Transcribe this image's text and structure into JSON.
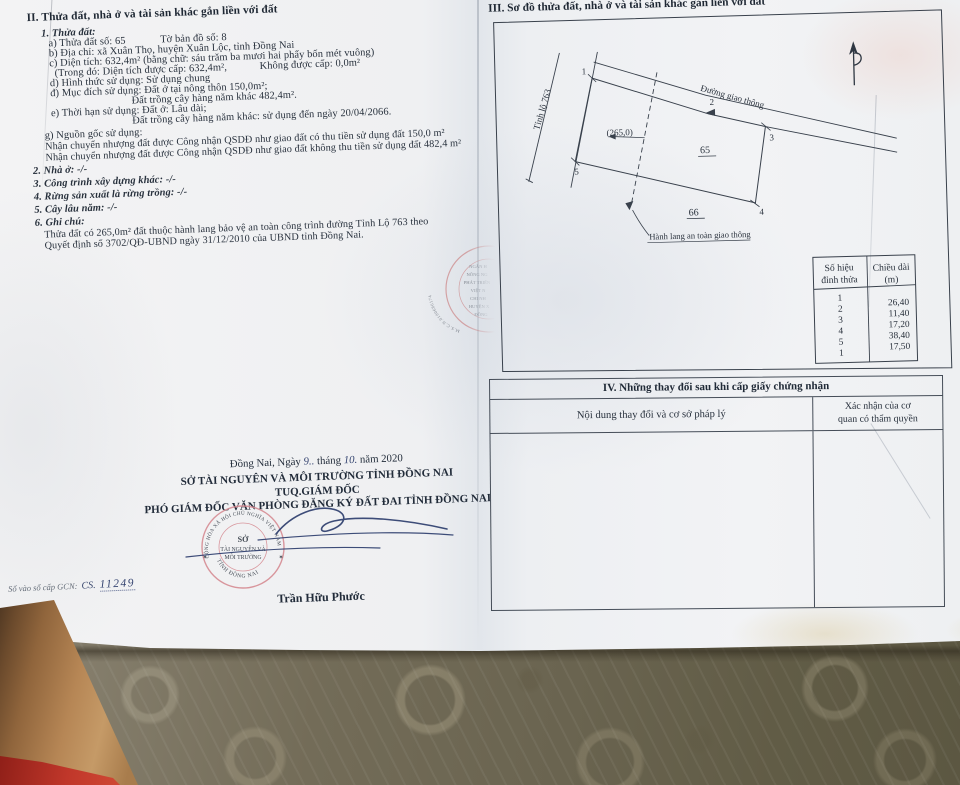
{
  "left": {
    "section2_title": "II. Thửa đất, nhà ở và tài sản khác gắn liền với đất",
    "item1_title": "1. Thửa đất:",
    "a_parcel": "a) Thửa đất số:  65",
    "a_map": "Tờ bản đồ số:   8",
    "b_address": "b) Địa chỉ: xã Xuân Thọ, huyện Xuân Lộc, tỉnh Đồng Nai",
    "c_area": "c) Diện tích: 632,4m² (bằng chữ: sáu trăm ba mươi hai phẩy bốn mét vuông)",
    "c2_in": "(Trong đó: Diện tích được cấp: 632,4m²,",
    "c2_not": "Không được cấp: 0,0m²",
    "d_form": "d) Hình thức sử dụng: Sử dụng chung",
    "dd_purpose": "đ) Mục đích sử dụng: Đất ở tại nông thôn 150,0m²;",
    "dd_purpose2": "Đất trồng cây hàng năm khác 482,4m².",
    "e_term": "e) Thời hạn sử dụng: Đất ở: Lâu dài;",
    "e_term2": "Đất trồng cây hàng năm khác: sử dụng đến ngày 20/04/2066.",
    "g_origin": "g) Nguồn gốc sử dụng:",
    "g_origin2": "Nhận chuyển nhượng đất được Công nhận QSDĐ như giao đất có thu tiền sử dụng đất 150,0 m²",
    "g_origin3": "Nhận chuyển nhượng đất được Công nhận QSDĐ như giao đất không thu tiền sử dụng đất 482,4 m²",
    "item2": "2. Nhà ở: -/-",
    "item3": "3. Công trình xây dựng khác:  -/-",
    "item4": "4. Rừng sản xuất là rừng trồng: -/-",
    "item5": "5. Cây lâu năm: -/-",
    "item6": "6. Ghi chú:",
    "note1": "Thửa đất có 265,0m² đất thuộc hành lang bảo vệ an toàn công trình đường Tỉnh Lộ 763 theo",
    "note2": "Quyết định số 3702/QĐ-UBND ngày 31/12/2010 của UBND tỉnh Đồng Nai.",
    "date_pre": "Đồng Nai, Ngày",
    "date_day": "9..",
    "date_mid": "tháng",
    "date_month": "10.",
    "date_post": "năm 2020",
    "org1": "SỞ TÀI NGUYÊN VÀ MÔI TRƯỜNG TỈNH ĐỒNG NAI",
    "org2": "TUQ.GIÁM ĐỐC",
    "org3": "PHÓ GIÁM ĐỐC VĂN PHÒNG ĐĂNG KÝ ĐẤT ĐAI TỈNH ĐỒNG NAI",
    "signer_name": "Trần Hữu Phước",
    "gcn_label": "Số vào sổ cấp GCN:",
    "gcn_code": "CS.",
    "gcn_number": "11249",
    "seal": {
      "ring_top": "CỘNG HÒA XÃ HỘI CHỦ NGHĨA VIỆT NAM",
      "center1": "SỞ",
      "center2": "TÀI NGUYÊN VÀ",
      "center3": "MÔI TRƯỜNG",
      "ring_bottom": "TỈNH ĐỒNG NAI",
      "star_left": "✶",
      "star_right": "✶"
    },
    "bank_stamp": {
      "arc": "M.S.C.N.0100686174",
      "l0": "NGÂN H",
      "l1": "NÔNG NG",
      "l2": "PHÁT TRIỂN",
      "l3": "VIỆT N",
      "l4": "CHI NH",
      "l5": "HUYỆN X",
      "l6": "ĐỒNG"
    }
  },
  "right": {
    "section3_title": "III. Sơ đồ thửa đất, nhà ở và tài sản khác gắn liền với đất",
    "diagram": {
      "road_left": "Tỉnh lộ 763",
      "road_top": "Đường giao thông",
      "area_note": "(265,0)",
      "parcel_no": "65",
      "parcel_below": "66",
      "corridor": "Hành lang an toàn giao thông",
      "v1": "1",
      "v2": "2",
      "v3": "3",
      "v4": "4",
      "v5": "5"
    },
    "vertex_table": {
      "h1a": "Số hiệu",
      "h1b": "đỉnh thửa",
      "h2a": "Chiều dài",
      "h2b": "(m)",
      "ids": [
        "1",
        "2",
        "3",
        "4",
        "5",
        "1"
      ],
      "lengths": [
        "26,40",
        "11,40",
        "17,20",
        "38,40",
        "17,50"
      ]
    },
    "section4_title": "IV. Những thay đổi sau khi cấp giấy chứng nhận",
    "section4_col1": "Nội dung thay đổi và cơ sở pháp lý",
    "section4_col2a": "Xác nhận của cơ",
    "section4_col2b": "quan có thẩm quyền"
  },
  "colors": {
    "ink": "#28313d",
    "seal_red": "#d4868e",
    "signature_blue": "#2e3f6e",
    "paper": "#f1f2f4",
    "tablecloth": "#6a6450"
  }
}
